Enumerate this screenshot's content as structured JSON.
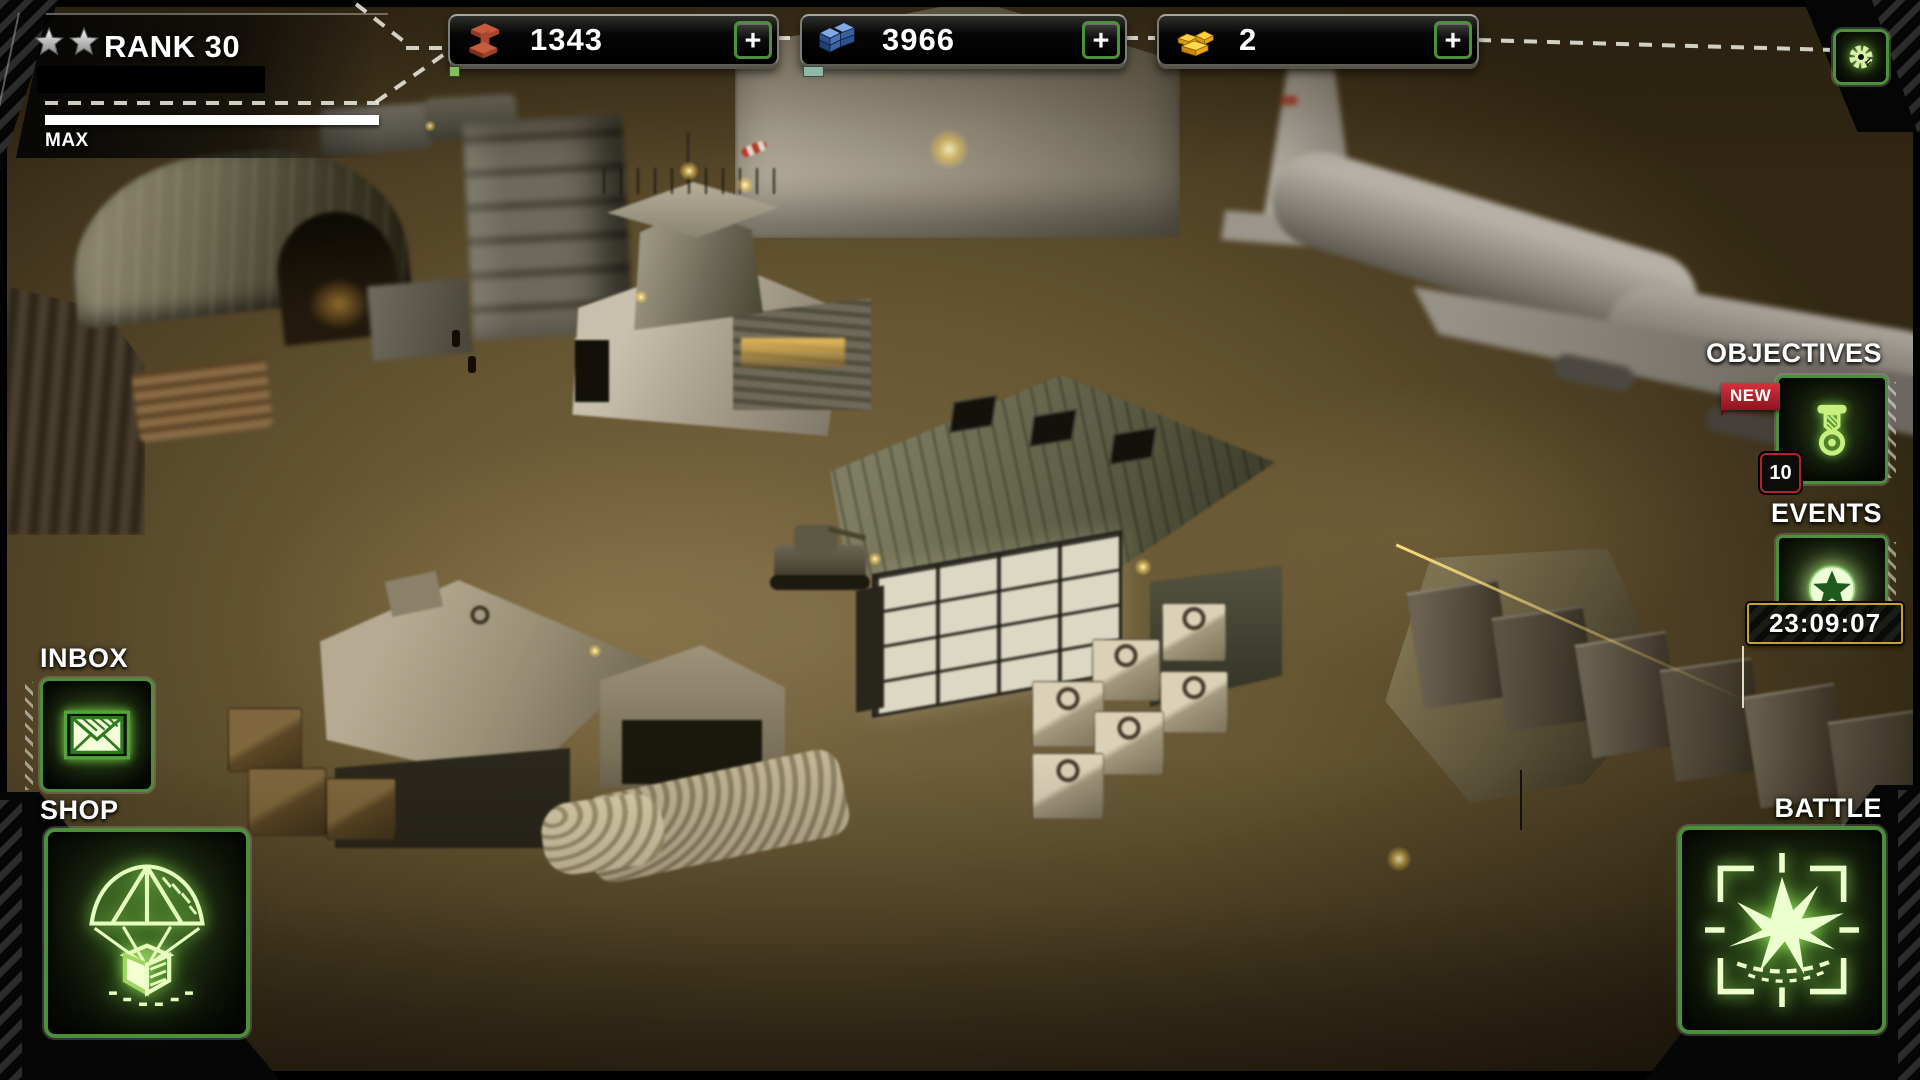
{
  "hud": {
    "rank": {
      "stars": 2,
      "label": "RANK 30",
      "max_label": "MAX"
    },
    "resources": [
      {
        "name": "steel",
        "icon": "steel-beam-icon",
        "value": "1343",
        "add_label": "+"
      },
      {
        "name": "supplies",
        "icon": "supply-crates-icon",
        "value": "3966",
        "add_label": "+"
      },
      {
        "name": "gold",
        "icon": "gold-bars-icon",
        "value": "2",
        "add_label": "+"
      }
    ],
    "settings": {
      "icon": "gear-icon"
    },
    "right_panel": {
      "objectives": {
        "label": "OBJECTIVES",
        "new_badge": "NEW",
        "count": "10",
        "icon": "medal-icon"
      },
      "events": {
        "label": "EVENTS",
        "icon": "event-star-icon",
        "timer": "23:09:07"
      }
    },
    "left_panel": {
      "inbox": {
        "label": "INBOX",
        "icon": "envelope-icon"
      },
      "shop": {
        "label": "SHOP",
        "icon": "airdrop-icon"
      }
    },
    "battle": {
      "label": "BATTLE",
      "icon": "explosion-crosshair-icon"
    },
    "colors": {
      "accent_green": "#4c8f3c",
      "glow_green": "#d9f7ad",
      "badge_red": "#b22330",
      "timer_gold": "#c9a12e",
      "steel_rust": "#c2593a",
      "supply_blue": "#5b86cc",
      "gold_yellow": "#f7c21f"
    }
  }
}
